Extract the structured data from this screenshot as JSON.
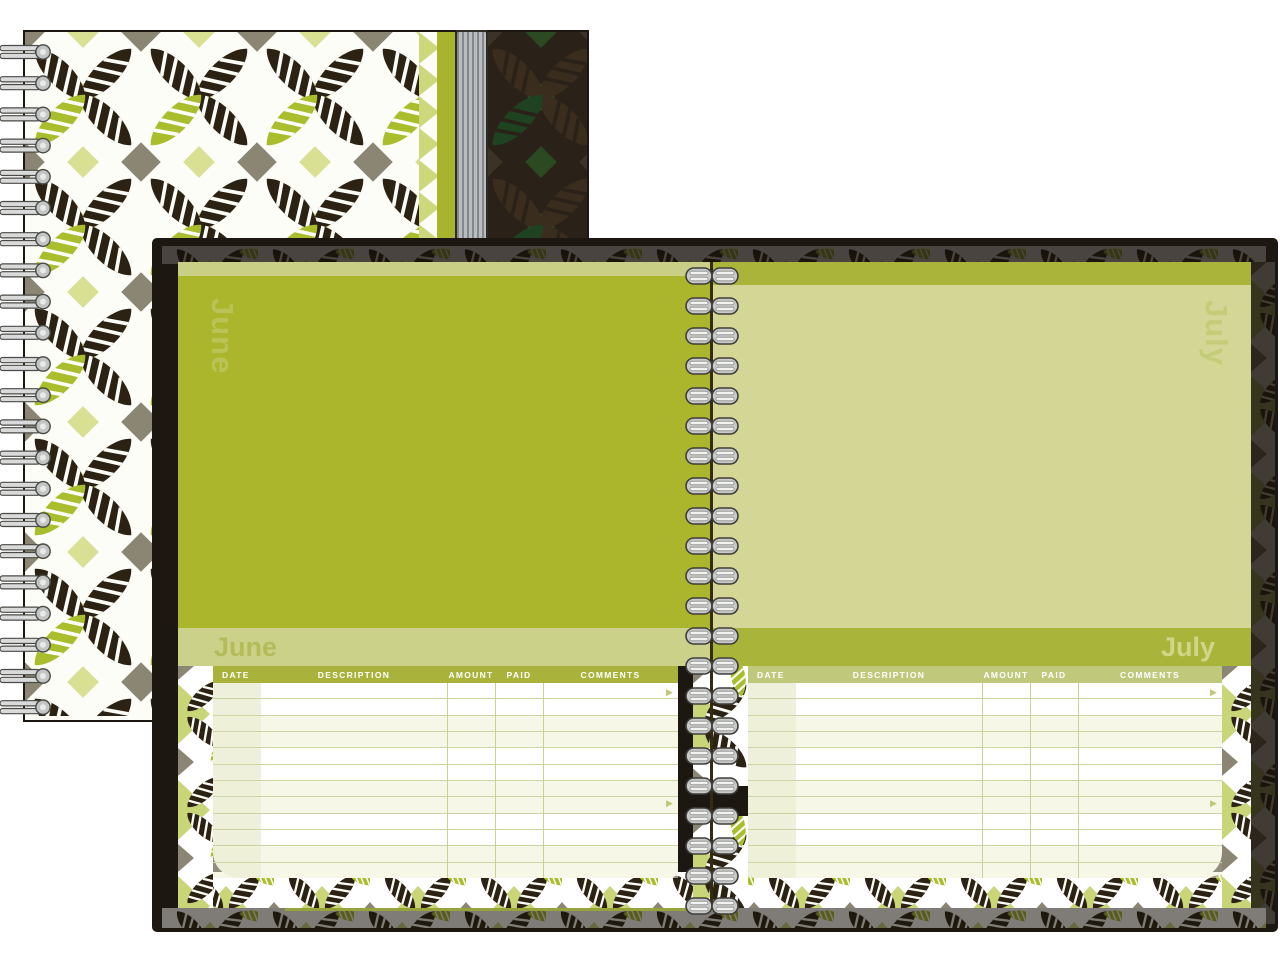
{
  "planner": {
    "left_page": {
      "month": "June"
    },
    "right_page": {
      "month": "July"
    }
  },
  "table": {
    "headers": [
      "DATE",
      "DESCRIPTION",
      "AMOUNT",
      "PAID",
      "COMMENTS"
    ],
    "row_count": 12,
    "arrow_glyph": "▶"
  },
  "colors": {
    "june_green": "#abb62c",
    "july_green": "#d3d694",
    "band_light": "#cbd189",
    "band_dark": "#a9b43a",
    "header_dark": "#a9b23b",
    "header_light": "#c0c87c",
    "cover_dark": "#1d1712",
    "leaf_dark": "#2c2214",
    "leaf_green": "#a9bd2d",
    "diamond_olive": "#8b8673",
    "diamond_lightgreen": "#d9e093",
    "wire_silver": "#c7cac9"
  }
}
